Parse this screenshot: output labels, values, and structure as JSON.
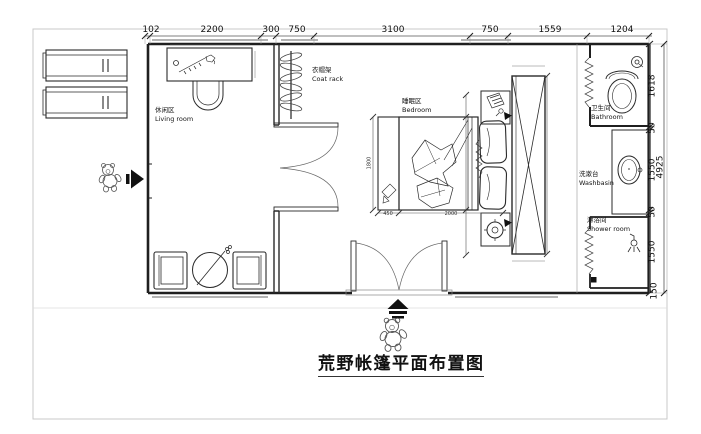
{
  "title": "荒野帐篷平面布置图",
  "rooms": {
    "living_zh": "休闲区",
    "living_en": "Living room",
    "coat_zh": "衣帽架",
    "coat_en": "Coat rack",
    "bedroom_zh": "睡眠区",
    "bedroom_en": "Bedroom",
    "bathroom_zh": "卫生间",
    "bathroom_en": "Bathroom",
    "washbasin_zh": "洗漱台",
    "washbasin_en": "Washbasin",
    "shower_zh": "淋浴间",
    "shower_en": "Shower room"
  },
  "dims_top": [
    "102",
    "2200",
    "300",
    "750",
    "3100",
    "750",
    "1559",
    "1204"
  ],
  "dims_right": [
    "1618",
    "50",
    "1550",
    "50",
    "1550",
    "150"
  ],
  "dims_right_total": "4925",
  "dims_bed": {
    "bench": "450",
    "length": "2000",
    "width": "1800"
  },
  "icons": {
    "entrance_left": "arrow-right-icon",
    "entrance_bottom": "arrow-up-icon",
    "mascots": "bear-figure",
    "fixtures": [
      "coat-rack",
      "toilet",
      "washbasin",
      "shower-head",
      "floor-drain",
      "wardrobe",
      "double-door",
      "sunbed",
      "desk",
      "armchair",
      "round-table",
      "bed"
    ]
  },
  "colors": {
    "wall": "#1f1f1f",
    "furniture": "#2a2a2a",
    "dimension": "#555555",
    "window": "#9a9a9a",
    "frame": "#c9c9c9",
    "paper": "#ffffff"
  }
}
